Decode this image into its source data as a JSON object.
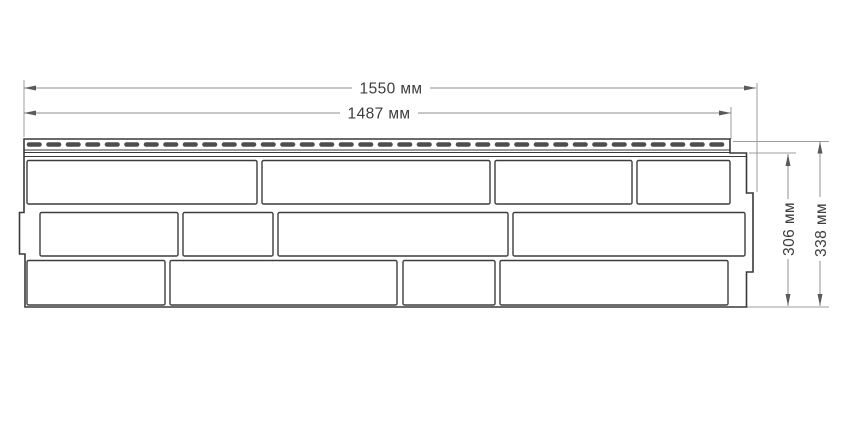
{
  "diagram": {
    "type": "technical-dimension-drawing",
    "subject": "facade-siding-panel-with-brick-pattern-and-perforated-nail-strip",
    "dimensions": {
      "total_width": "1550 мм",
      "nail_strip_width": "1487 мм",
      "panel_height": "306 мм",
      "total_height": "338 мм"
    },
    "units": "мм",
    "colors": {
      "background": "#ffffff",
      "panel_line": "#3a3a3a",
      "brick_line": "#3d3d3d",
      "slot_fill": "#4d4d4d",
      "dimension_line": "#8f8f8f",
      "dimension_text": "#3d3d3d"
    },
    "counts": {
      "brick_rows": 3,
      "bricks_per_row": 4
    }
  }
}
